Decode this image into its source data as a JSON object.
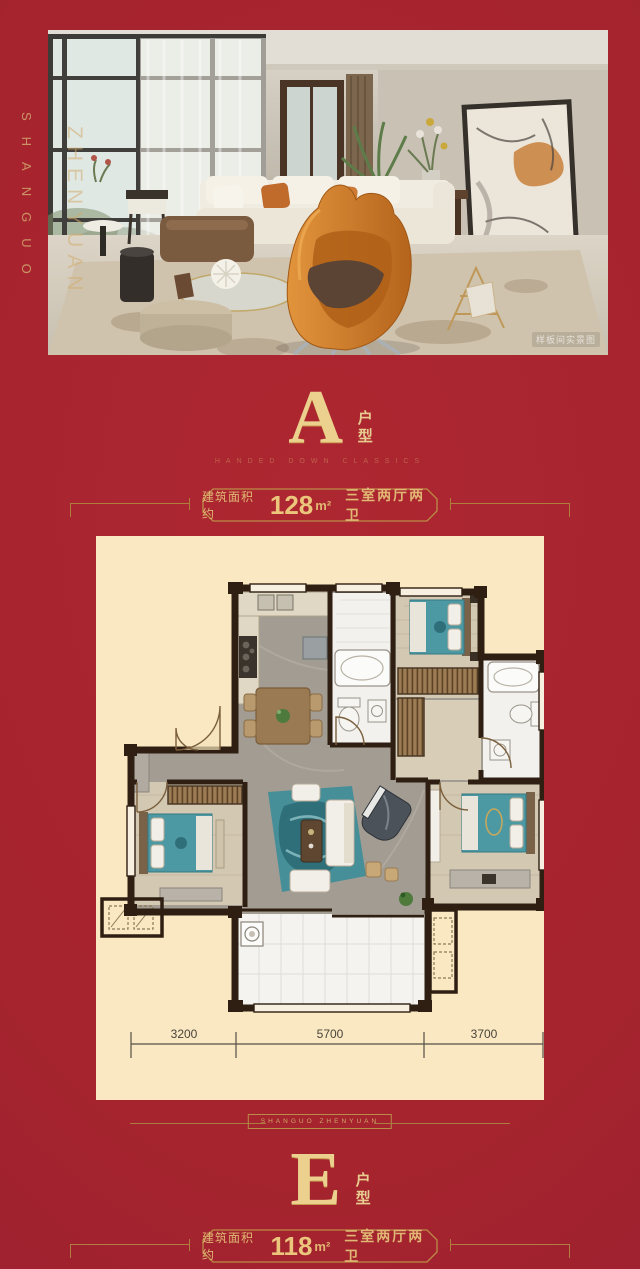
{
  "colors": {
    "red": "#a6242e",
    "gold": "#d9b26e",
    "cream": "#f9e8c1",
    "teal_bed": "#4d99a3"
  },
  "brand": {
    "left_vertical": "SHANGUO",
    "photo_overlay_vertical": "ZHENYUAN"
  },
  "photo": {
    "watermark": "样板间实景图"
  },
  "section_a": {
    "letter": "A",
    "type_label": "户型",
    "subtitle": "HANDED DOWN CLASSICS",
    "banner": {
      "area_prefix": "建筑面积约",
      "area_value": "128",
      "area_unit": "m²",
      "layout": "三室两厅两卫"
    }
  },
  "divider": {
    "label": "SHANGUO ZHENYUAN"
  },
  "section_e": {
    "letter": "E",
    "type_label": "户型",
    "banner": {
      "area_prefix": "建筑面积约",
      "area_value": "118",
      "area_unit": "m²",
      "layout": "三室两厅两卫"
    }
  },
  "floorplan": {
    "dimensions": [
      "3200",
      "5700",
      "3700"
    ]
  }
}
